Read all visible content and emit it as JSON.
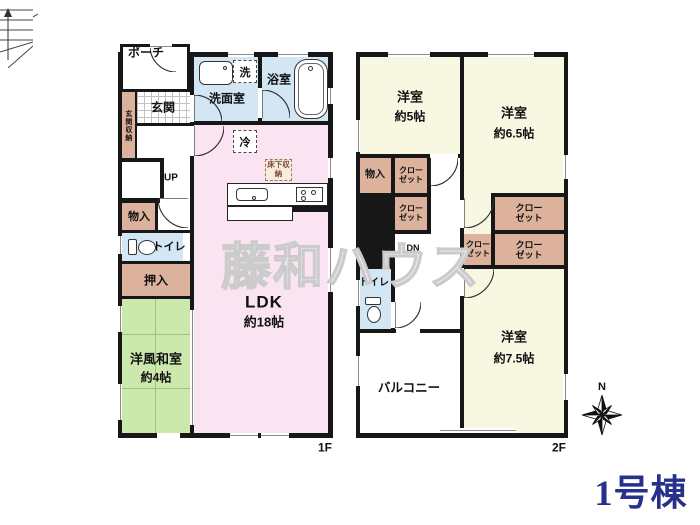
{
  "title": "1号棟",
  "watermark": "藤和ハウス",
  "compass": {
    "north": "N"
  },
  "palette": {
    "room_pink": "#fae4f2",
    "room_blue": "#d2e6f4",
    "tatami_green": "#cde8ac",
    "room_cream": "#f8f8e2",
    "closet_brown": "#dcb29c",
    "wall": "#171717",
    "title_navy": "#28308e"
  },
  "f1": {
    "floor_label": "1F",
    "porch": "ポーチ",
    "genkan": "玄関",
    "genkan_storage": "玄関収納",
    "stairs_up": "UP",
    "storage": "物入",
    "toilet": "トイレ",
    "oshiire": "押入",
    "washitsu": {
      "label": "洋風和室",
      "size": "約4帖"
    },
    "senmen": "洗面室",
    "laundry": "洗",
    "bath": "浴室",
    "fridge": "冷",
    "underfloor": "床下収納",
    "ldk": {
      "label": "LDK",
      "size": "約18帖"
    }
  },
  "f2": {
    "floor_label": "2F",
    "room5": {
      "label": "洋室",
      "size": "約5帖"
    },
    "room65": {
      "label": "洋室",
      "size": "約6.5帖"
    },
    "room75": {
      "label": "洋室",
      "size": "約7.5帖"
    },
    "storage": "物入",
    "closet": "クローゼット",
    "stairs_down": "DN",
    "toilet": "トイレ",
    "balcony": "バルコニー"
  }
}
